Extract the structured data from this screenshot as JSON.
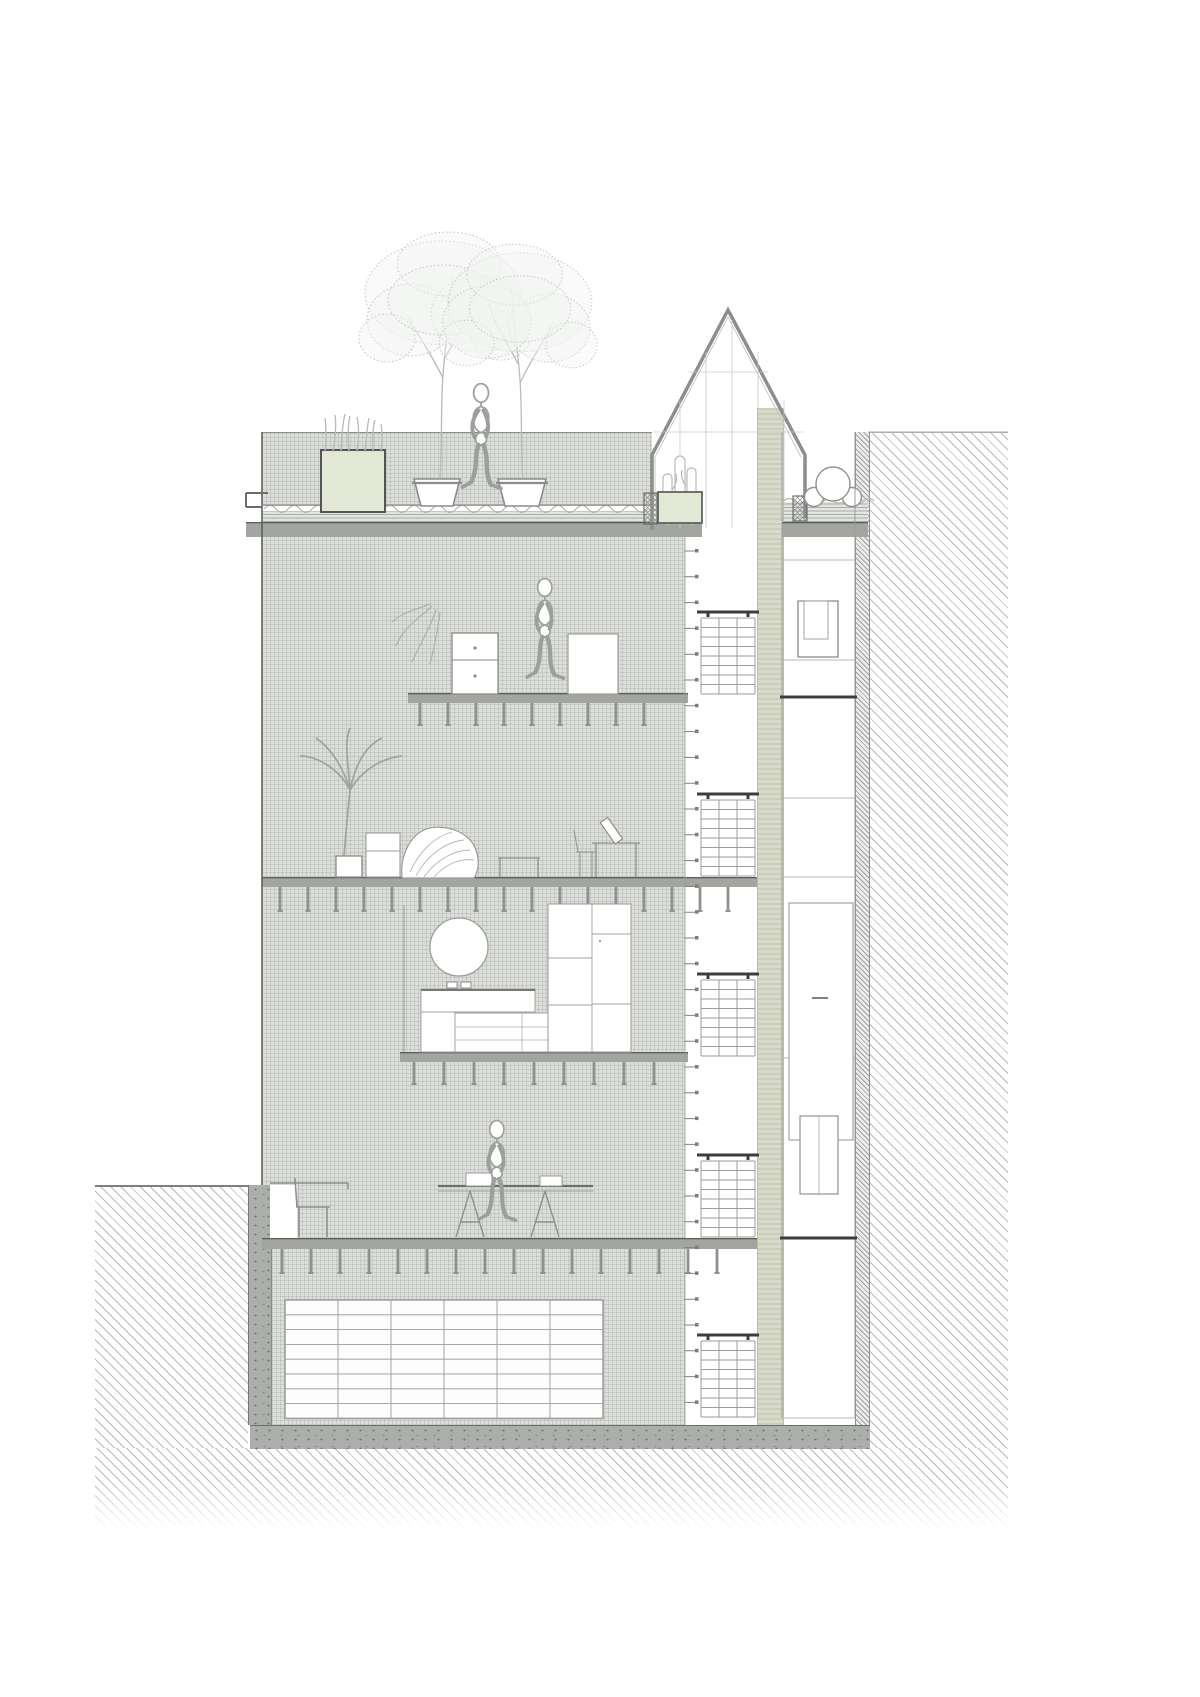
{
  "meta": {
    "title": "residential-building-cross-section-drawing",
    "drawing_type": "architectural section / elevation, monochrome line drawing",
    "visible_text": "none"
  },
  "palette": {
    "ink": "#5d605d",
    "dark": "#3c3e3c",
    "slab": "#a2a5a0",
    "slab-edge": "#5a5d5a",
    "stipple-bg": "#dcdeda",
    "stipple-dot": "rgba(130,136,130,0.22)",
    "hatch-line": "#b7bab7",
    "hatch-dense": "#9da09d",
    "strip-bg": "#d8dbc9",
    "speckle-bg": "#abaeab",
    "planter": "#e3e7d6",
    "line-light": "#aaadaa"
  },
  "objects": [
    "roof-garden-with-two-potted-trees",
    "grass-planter-box",
    "walking-mannequin-on-roof",
    "glass-greenhouse-with-gabled-roof",
    "cactus-in-greenhouse",
    "three-round-pipes-on-right-roof",
    "bedroom-level-with-dresser-and-mannequin",
    "living-level-with-palm-plant-pouf-and-desk",
    "kitchen-mezzanine-with-round-mirror-counter-and-tall-cabinets",
    "ground-level-with-dining-table-chair-and-mannequin",
    "basement-storage-grid-shelving",
    "staircase-shaft-with-five-flights",
    "elevator-service-shaft",
    "side-room-column-with-windows-and-door",
    "neighbor-building-hatched",
    "party-wall",
    "street-ground-left",
    "excavated-earth-below"
  ],
  "drawing": {
    "slabs": [
      {
        "x": 246,
        "y": 522,
        "w": 456,
        "h": 15
      },
      {
        "x": 782,
        "y": 522,
        "w": 86,
        "h": 15
      },
      {
        "x": 408,
        "y": 693,
        "w": 280,
        "h": 10
      },
      {
        "x": 262,
        "y": 877,
        "w": 495,
        "h": 10
      },
      {
        "x": 400,
        "y": 1052,
        "w": 288,
        "h": 10
      },
      {
        "x": 262,
        "y": 1238,
        "w": 495,
        "h": 11
      }
    ],
    "joists": [
      {
        "y": 703,
        "x0": 420,
        "n": 9,
        "step": 28,
        "len": 22
      },
      {
        "y": 887,
        "x0": 280,
        "n": 17,
        "step": 28,
        "len": 24
      },
      {
        "y": 1062,
        "x0": 414,
        "n": 9,
        "step": 30,
        "len": 22
      },
      {
        "y": 1249,
        "x0": 282,
        "n": 16,
        "step": 29,
        "len": 24
      }
    ],
    "stairs": [
      {
        "x": 701,
        "w": 54,
        "rail": 612,
        "top": 618,
        "bot": 694
      },
      {
        "x": 701,
        "w": 54,
        "rail": 794,
        "top": 800,
        "bot": 876
      },
      {
        "x": 701,
        "w": 54,
        "rail": 974,
        "top": 980,
        "bot": 1056
      },
      {
        "x": 701,
        "w": 54,
        "rail": 1155,
        "top": 1161,
        "bot": 1237
      },
      {
        "x": 701,
        "w": 54,
        "rail": 1335,
        "top": 1341,
        "bot": 1417
      }
    ],
    "ticks": {
      "x": 684,
      "w": 13,
      "y0": 551,
      "y1": 1412,
      "step": 25.8
    },
    "basement_grid": {
      "x": 285,
      "y": 1300,
      "cols": 6,
      "rows": 8,
      "cw": 53,
      "rh": 14.8
    },
    "squiggles": [
      {
        "x0": 264,
        "x1": 648,
        "y": 509,
        "seg": 12,
        "amp": 7
      },
      {
        "x0": 784,
        "x1": 866,
        "y": 501,
        "seg": 10,
        "amp": 5
      }
    ],
    "figures": [
      {
        "transform": "translate(455,383) scale(1.24)"
      },
      {
        "transform": "translate(520,578) scale(1.18)"
      },
      {
        "transform": "translate(472,1120) scale(1.18)"
      }
    ],
    "trees": [
      {
        "transform": "translate(443,478)"
      },
      {
        "transform": "translate(520,478) scale(-0.92,0.95)"
      }
    ]
  }
}
